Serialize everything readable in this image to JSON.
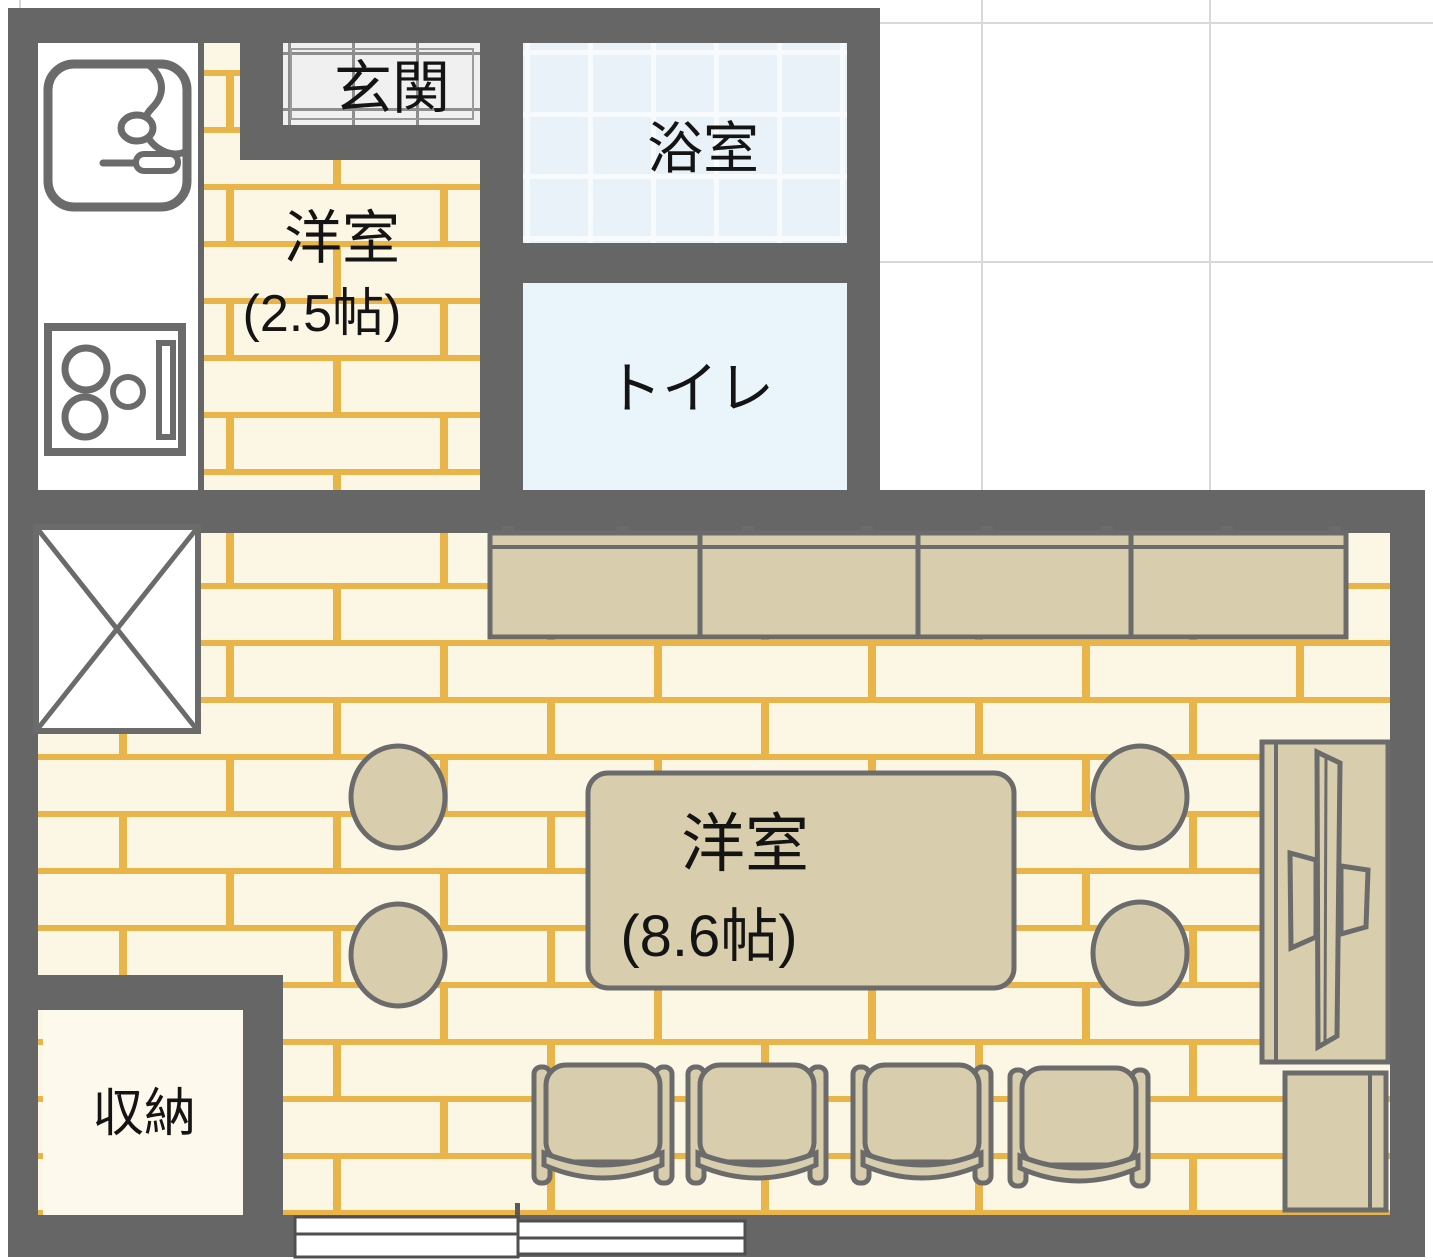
{
  "floorplan": {
    "rooms": {
      "entrance": {
        "label": "玄関"
      },
      "bath": {
        "label": "浴室"
      },
      "toilet": {
        "label": "トイレ"
      },
      "western_room_small": {
        "label": "洋室",
        "size": "(2.5帖)"
      },
      "western_room_main": {
        "label": "洋室",
        "size": "(8.6帖)"
      },
      "storage": {
        "label": "収納"
      }
    },
    "colors": {
      "wall": "#666666",
      "brick_base": "#FCF7E5",
      "brick_mortar": "#E9B54B",
      "bath_tile_base": "#E9F2F8",
      "bath_tile_line": "#F8FBFD",
      "toilet_floor": "#EAF5FB",
      "entrance_tile_base": "#F0F0F0",
      "entrance_tile_line": "#8D8D8D",
      "kitchen_floor": "#FFFFFF",
      "storage_floor": "#FDF9EC",
      "furniture": "#D8CEAD",
      "outline": "#6B6B6B",
      "outside_grid_line": "#D9D9D9",
      "label_text": "#141414"
    }
  }
}
